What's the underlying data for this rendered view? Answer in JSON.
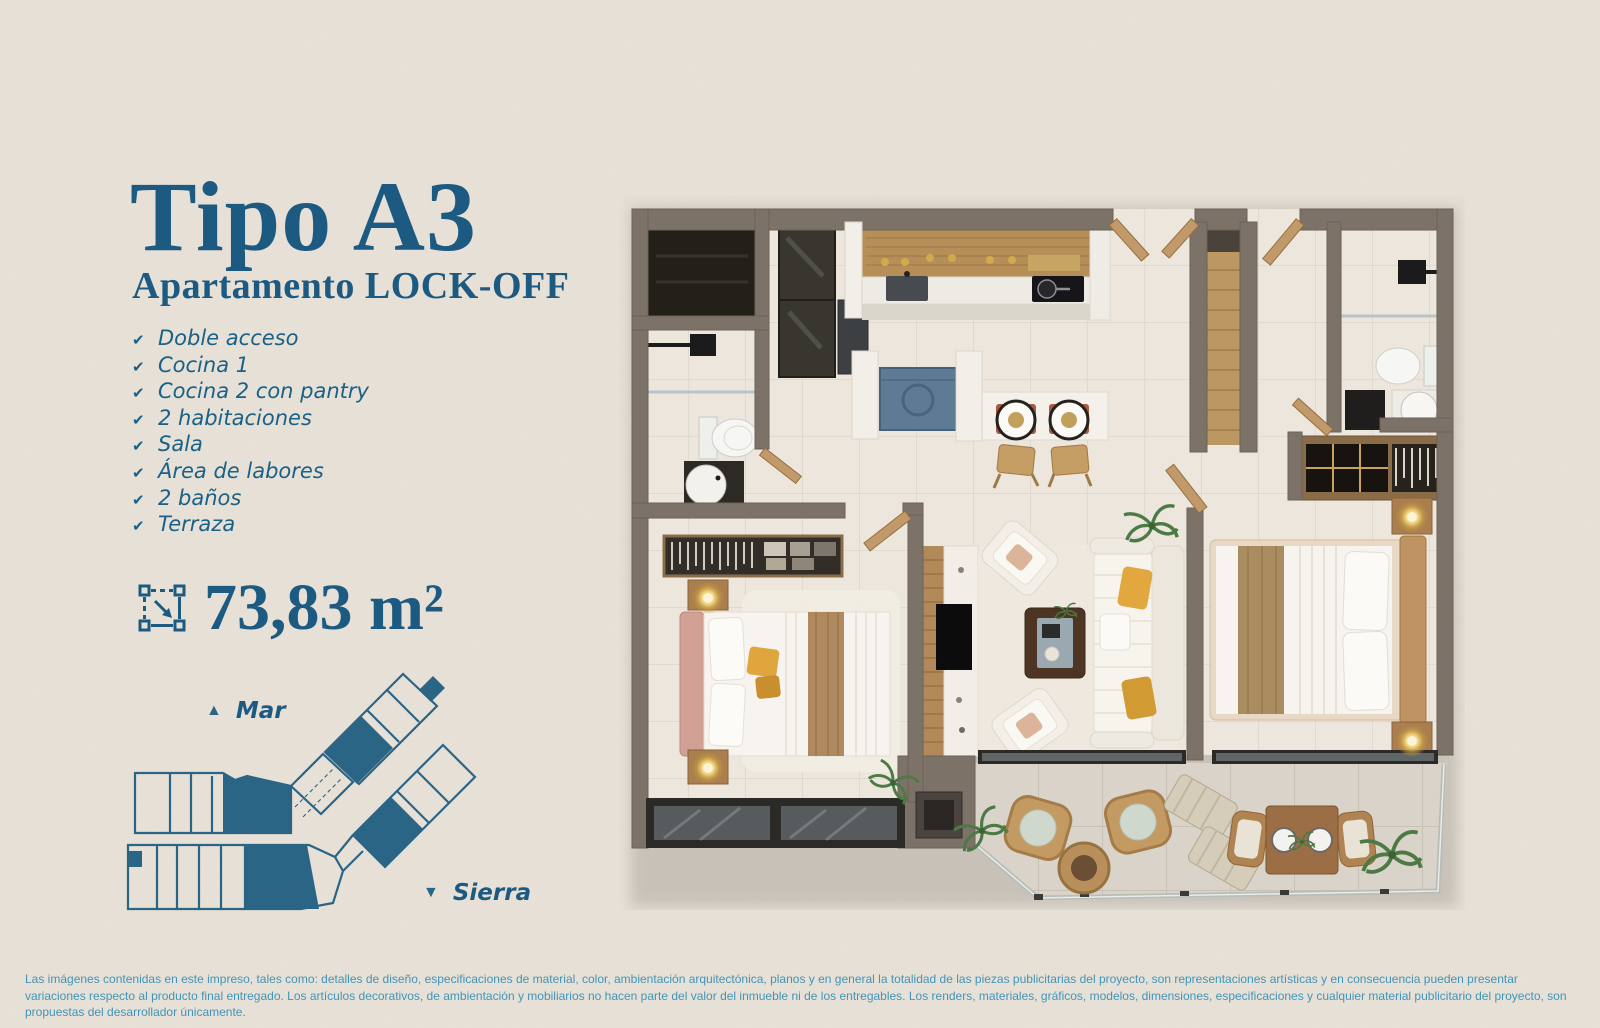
{
  "header": {
    "title": "Tipo A3",
    "subtitle": "Apartamento LOCK-OFF"
  },
  "features": [
    "Doble acceso",
    "Cocina 1",
    "Cocina 2 con pantry",
    "2 habitaciones",
    "Sala",
    "Área de labores",
    "2 baños",
    "Terraza"
  ],
  "area": {
    "value": "73,83 m²",
    "icon": "measure-area-icon"
  },
  "compass": {
    "sea_label": "Mar",
    "mountain_label": "Sierra"
  },
  "glyphs": {
    "check": "✔",
    "triangle_up": "▲",
    "triangle_down": "▼"
  },
  "keyplan": {
    "icon": "building-key-plan",
    "highlight_color": "#2b6586"
  },
  "floorplan": {
    "icon": "apartment-3d-floorplan-render",
    "rooms": [
      "closet",
      "bathroom-1",
      "entry",
      "kitchen-1",
      "laundry-nook",
      "breakfast-bar",
      "pantry-hall",
      "corridor-lockoff",
      "bathroom-2",
      "closet-2",
      "bedroom-1",
      "tv-wall",
      "living-room",
      "bedroom-2",
      "terrace"
    ]
  },
  "disclaimer": {
    "text": "Las imágenes contenidas en este impreso, tales como: detalles de diseño, especificaciones de material, color, ambientación arquitectónica, planos y en general la totalidad de las piezas publicitarias del proyecto, son representaciones artísticas y en consecuencia pueden presentar variaciones respecto al producto final entregado. Los artículos decorativos, de ambientación y mobiliarios no hacen parte del valor del inmueble ni de los entregables. Los renders, materiales, gráficos, modelos, dimensiones, especificaciones y cualquier material publicitario del proyecto, son propuestas del desarrollador únicamente."
  },
  "colors": {
    "background": "#e9e3d9",
    "accent_blue": "#1d5a82",
    "feature_blue": "#1a6187",
    "disclaimer_blue": "#4295b8",
    "keyplan_blue": "#2b6586",
    "wall": "#7d7268",
    "floor": "#ece6dd",
    "terrace_floor": "#d9d3c9",
    "wood": "#c2996a",
    "washer_blue": "#5d7b95",
    "headboard_pink": "#d2a094",
    "pillow_yellow": "#e0a83e"
  }
}
